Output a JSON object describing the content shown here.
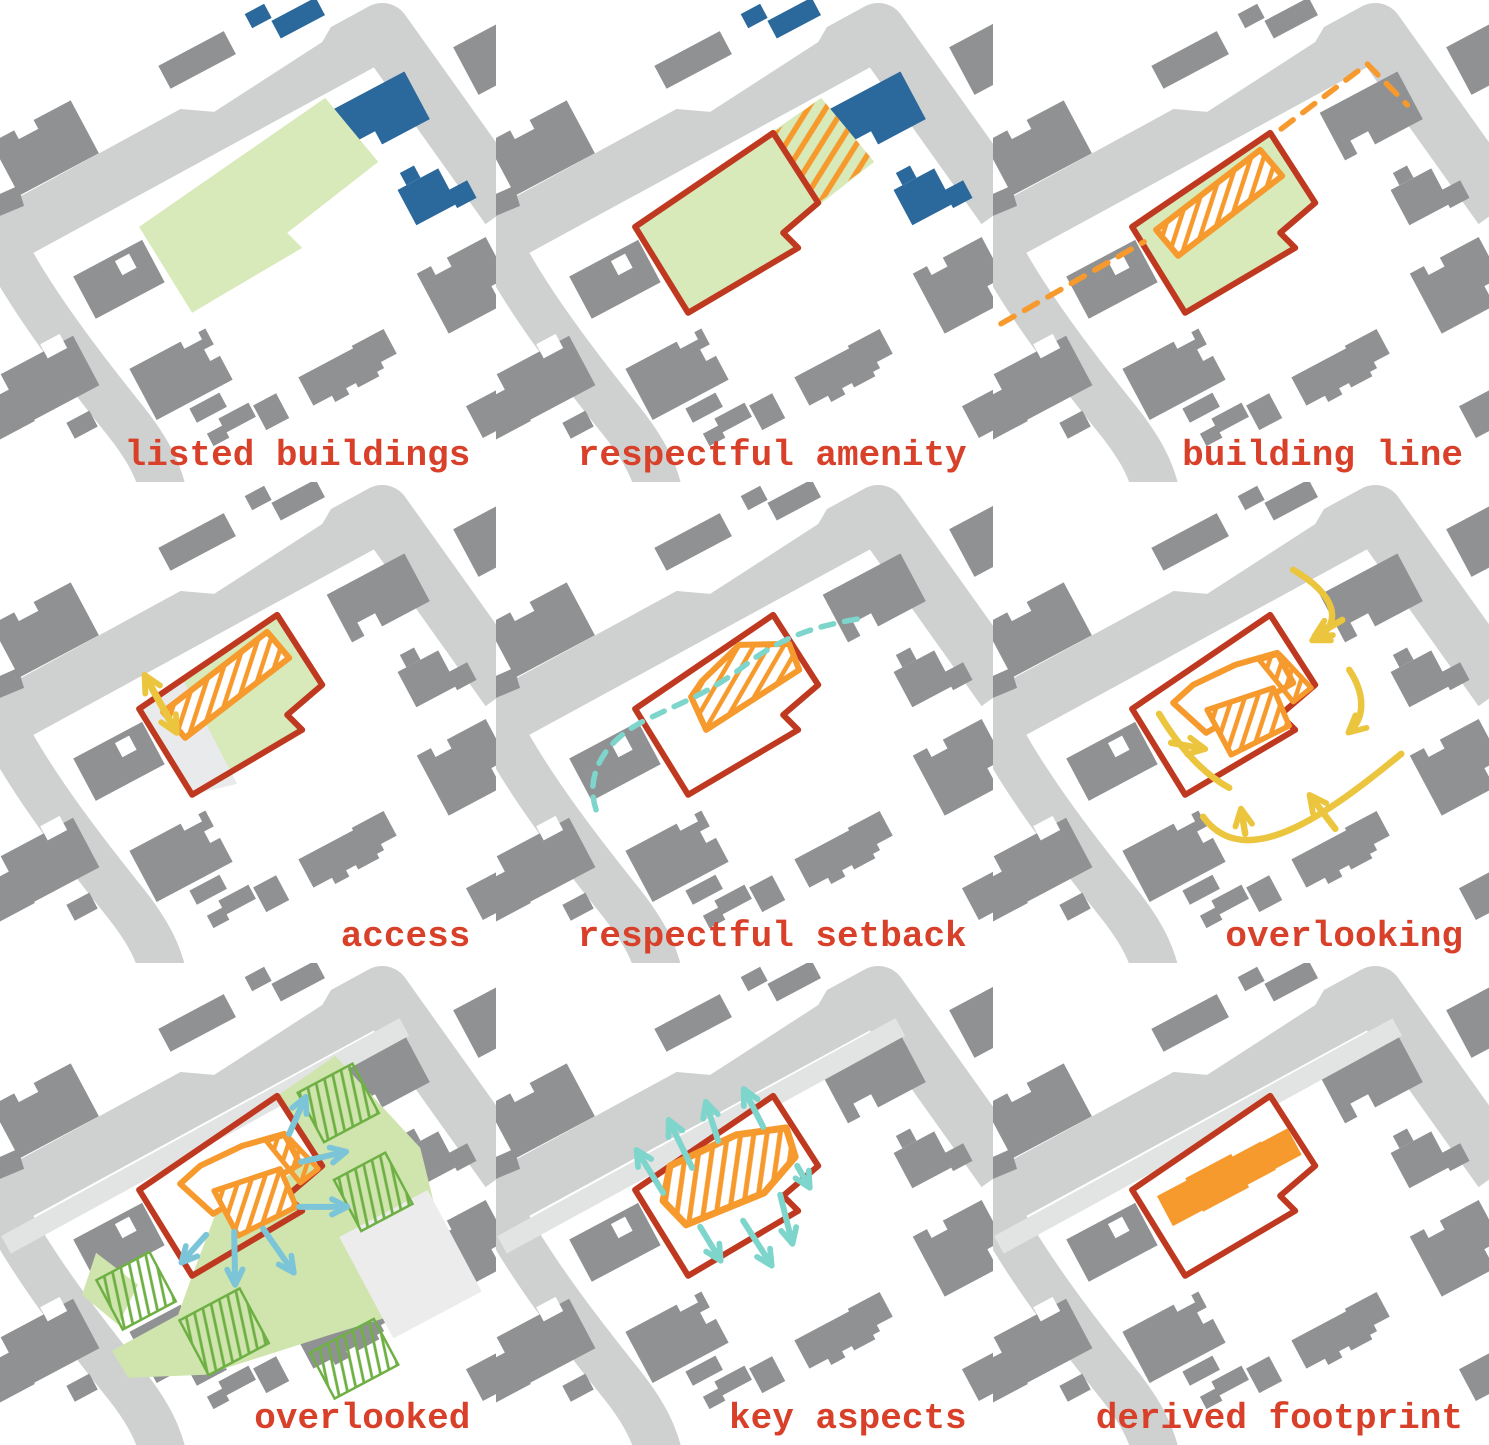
{
  "panels": [
    {
      "name": "listed-buildings",
      "label": "listed buildings"
    },
    {
      "name": "respectful-amenity",
      "label": "respectful amenity"
    },
    {
      "name": "building-line",
      "label": "building line"
    },
    {
      "name": "access",
      "label": "access"
    },
    {
      "name": "respectful-setback",
      "label": "respectful setback"
    },
    {
      "name": "overlooking",
      "label": "overlooking"
    },
    {
      "name": "overlooked",
      "label": "overlooked"
    },
    {
      "name": "key-aspects",
      "label": "key aspects"
    },
    {
      "name": "derived-footprint",
      "label": "derived footprint"
    }
  ],
  "colors": {
    "label_red": "#d8402a",
    "boundary_red": "#bf3920",
    "site_green": "#d8e9ba",
    "garden_green": "#cfe5ad",
    "garden_hatch_green": "#6fb045",
    "building_gray": "#8f9193",
    "road_gray": "#cfd1d1",
    "pavement_light": "#ececec",
    "listed_blue": "#2b689c",
    "sketch_orange": "#f79a2d",
    "arrow_yellow": "#ecc53e",
    "arrow_teal": "#7ed5cc",
    "arrow_blue": "#7cc5d9"
  }
}
